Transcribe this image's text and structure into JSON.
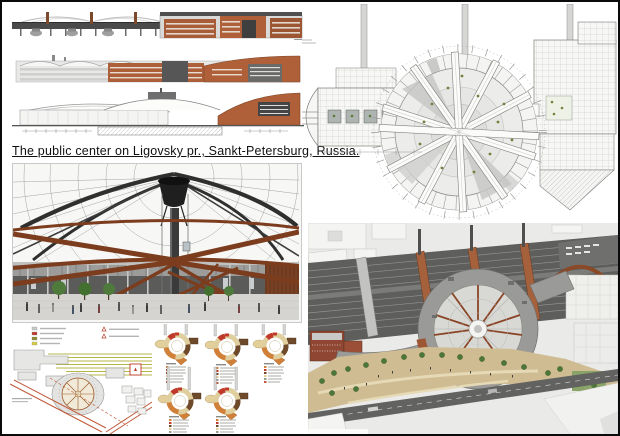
{
  "poster": {
    "title": "The public center on Ligovsky pr., Sankt-Petersburg, Russia."
  },
  "colors": {
    "brick": "#AD5F3A",
    "brick_dark": "#8F4632",
    "rust_beam": "#7C3D1F",
    "rust_bridge": "#A4613C",
    "dark_steel": "#2F2F2F",
    "rail_gray": "#5E5E5C",
    "roof_gray": "#9A9A98",
    "dome_glass": "#D8D8D4",
    "plaza_tan": "#CFBC92",
    "tree_green": "#4C763A",
    "site_rail_yellow": "#B9B648",
    "site_road_red": "#C05A3A",
    "diagram_cream": "#E0CF9E",
    "diagram_orange": "#D08038",
    "diagram_red": "#BF3A2A",
    "diagram_brown": "#6E4A2B",
    "plan_line_gray": "#8A8A88"
  }
}
